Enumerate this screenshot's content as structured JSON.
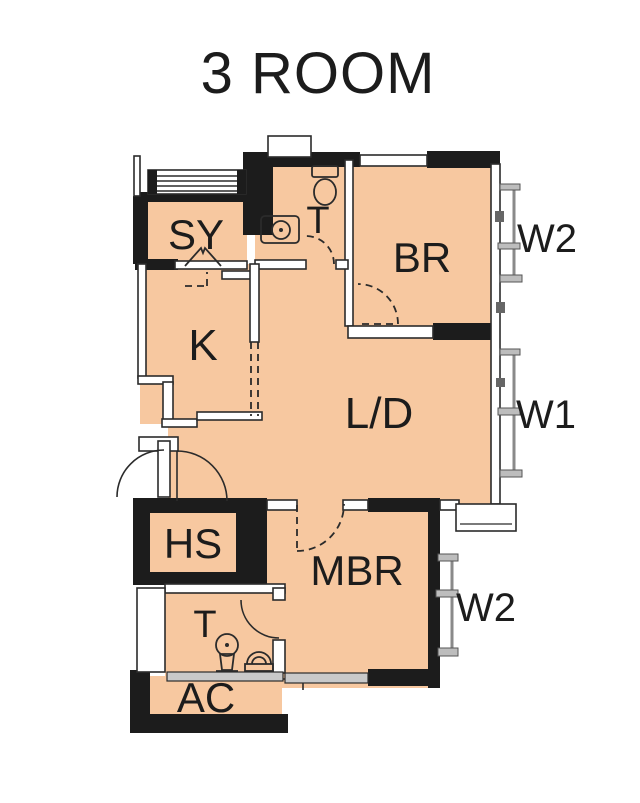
{
  "title": "3 ROOM",
  "colors": {
    "floor": "#f7c8a0",
    "wall": "#1c1c1c",
    "line": "#2b2b2b",
    "sill": "#c9c9c9",
    "bracket": "#8a8a8a",
    "background": "#ffffff",
    "ink": "#1c1c1c"
  },
  "rooms": [
    {
      "id": "sy",
      "label": "SY"
    },
    {
      "id": "toilet-top",
      "label": "T"
    },
    {
      "id": "bedroom",
      "label": "BR"
    },
    {
      "id": "kitchen",
      "label": "K"
    },
    {
      "id": "living-dining",
      "label": "L/D"
    },
    {
      "id": "hose-reel",
      "label": "HS"
    },
    {
      "id": "master-bedroom",
      "label": "MBR"
    },
    {
      "id": "toilet-bottom",
      "label": "T"
    },
    {
      "id": "ac-platform",
      "label": "AC"
    }
  ],
  "windows": [
    {
      "id": "w2-top",
      "label": "W2"
    },
    {
      "id": "w1",
      "label": "W1"
    },
    {
      "id": "w2-bottom",
      "label": "W2"
    }
  ]
}
